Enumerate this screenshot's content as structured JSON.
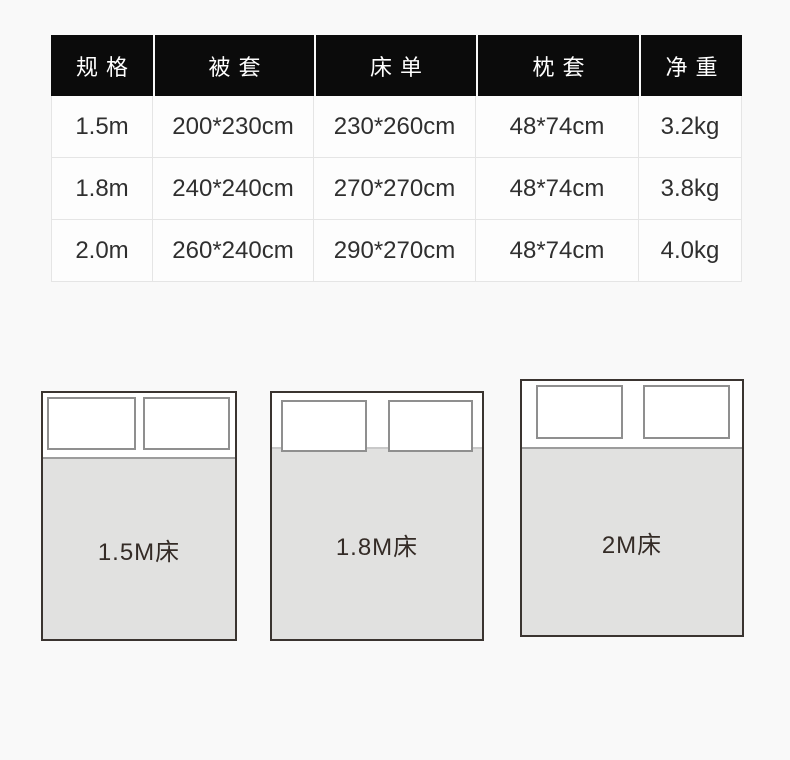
{
  "chart_data": {
    "type": "table",
    "columns": [
      "规格",
      "被套",
      "床单",
      "枕套",
      "净重"
    ],
    "rows": [
      [
        "1.5m",
        "200*230cm",
        "230*260cm",
        "48*74cm",
        "3.2kg"
      ],
      [
        "1.8m",
        "240*240cm",
        "270*270cm",
        "48*74cm",
        "3.8kg"
      ],
      [
        "2.0m",
        "260*240cm",
        "290*270cm",
        "48*74cm",
        "4.0kg"
      ]
    ]
  },
  "diagrams": [
    {
      "label": "1.5M床"
    },
    {
      "label": "1.8M床"
    },
    {
      "label": "2M床"
    }
  ],
  "colors": {
    "page_bg": "#f9f9f9",
    "header_bg": "#0b0b0b",
    "header_text": "#ffffff",
    "cell_bg": "#fdfdfd",
    "cell_border": "#e5e5e5",
    "cell_text": "#2f2f2f",
    "bed_border": "#3a3430",
    "mattress_fill": "#e1e1e0",
    "mattress_edge": "#9c9c9c",
    "pillow_border": "#8f8f8f",
    "bed_label_text": "#342b26"
  }
}
